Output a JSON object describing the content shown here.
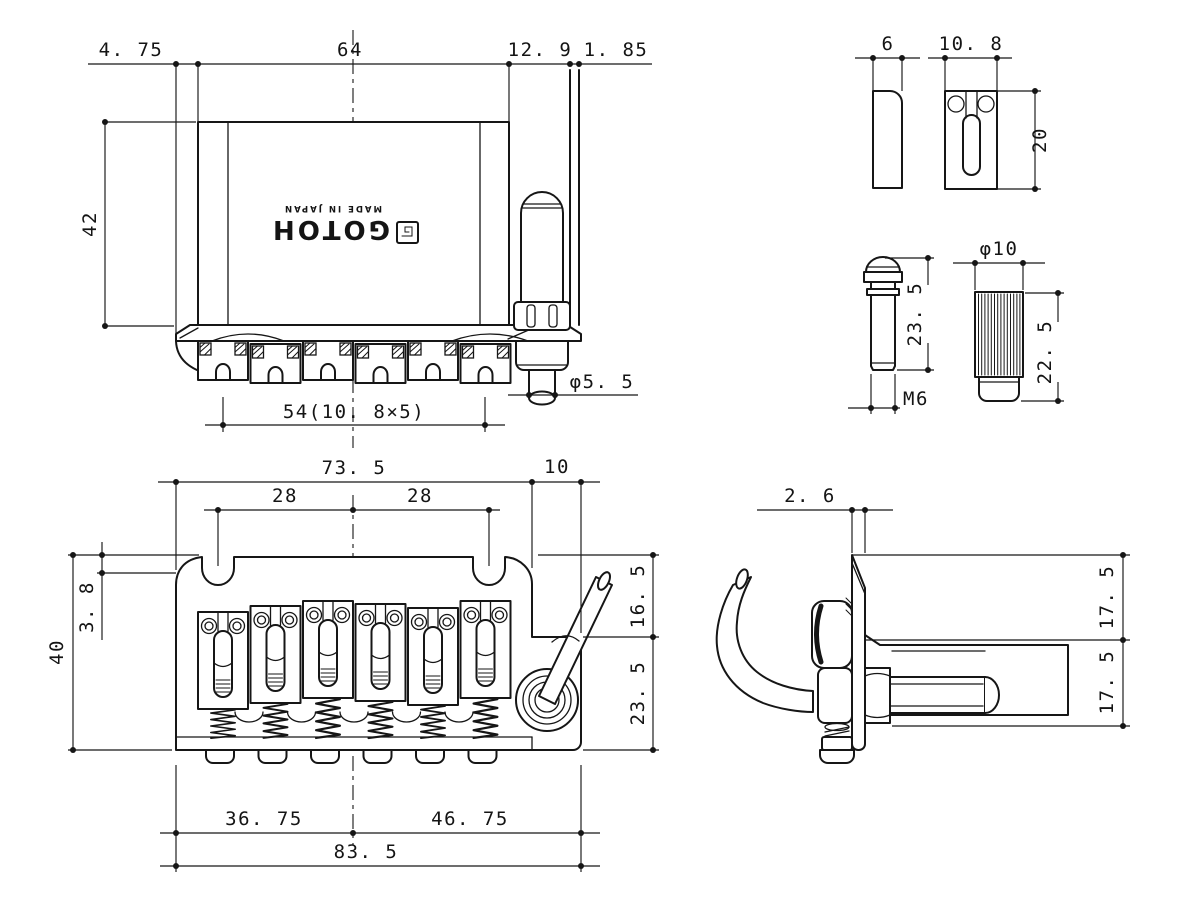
{
  "drawing": {
    "background": "#ffffff",
    "line_color": "#161616",
    "logo": {
      "brand": "GOTOH",
      "made_in": "MADE IN JAPAN"
    },
    "top_view": {
      "dim_left_offset": "4. 75",
      "dim_body_width": "64",
      "dim_right_offset": "12. 9",
      "dim_lip": "1. 85",
      "dim_height": "42",
      "dim_string_spread": "54(10. 8×5)",
      "dim_arm_diameter": "φ5. 5"
    },
    "saddle_side_view": {
      "dim_thickness": "6"
    },
    "saddle_plan_view": {
      "dim_width": "10. 8",
      "dim_length": "20"
    },
    "stud_view": {
      "dim_length": "23. 5",
      "dim_thread": "M6"
    },
    "bushing_view": {
      "dim_diameter": "φ10",
      "dim_length": "22. 5"
    },
    "front_view": {
      "dim_plate_width": "73. 5",
      "dim_arm_offset": "10",
      "dim_pivot_left": "28",
      "dim_pivot_right": "28",
      "dim_top_lip": "3. 8",
      "dim_height": "40",
      "dim_upper_right": "16. 5",
      "dim_lower_right": "23. 5",
      "dim_left_of_center": "36. 75",
      "dim_right_of_center": "46. 75",
      "dim_total_width": "83. 5"
    },
    "side_view": {
      "dim_plate_thickness": "2. 6",
      "dim_upper": "17. 5",
      "dim_lower": "17. 5"
    }
  }
}
